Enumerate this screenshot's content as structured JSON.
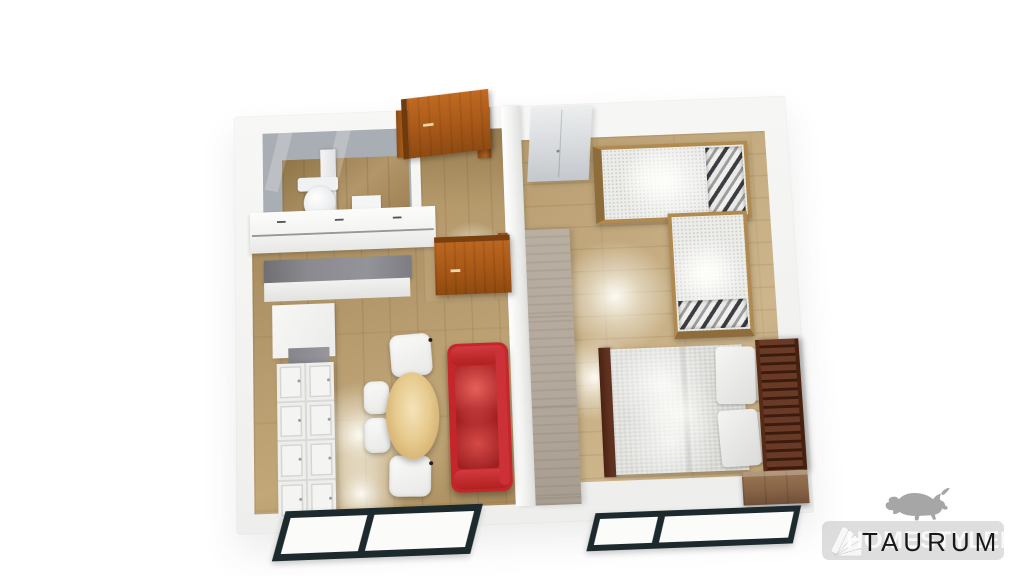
{
  "scene": {
    "description": "3D top-down render of a one-bedroom apartment floor plan",
    "rooms": [
      "bathroom",
      "entry-hall",
      "kitchen-living-dining",
      "bedroom"
    ],
    "furniture": [
      "kitchen-cabinets",
      "kitchen-counter",
      "dining-table",
      "dining-chairs",
      "red-sofa",
      "entry-door",
      "interior-door",
      "toilet",
      "bathroom-sink",
      "white-wardrobe",
      "taupe-wardrobe-divider",
      "l-shaped-daybed",
      "striped-pillows",
      "double-bed",
      "bed-pillows",
      "wood-dresser",
      "living-room-window",
      "bedroom-window"
    ]
  },
  "watermark": {
    "brand_text": "TAURUM",
    "ghost_text": "HOMESTYLER",
    "icons": [
      "bull-icon",
      "fan-icon"
    ],
    "text_color": "#181818",
    "bull_color": "#a6a6a6",
    "bar_color": "rgba(0,0,0,0.13)"
  },
  "palette": {
    "background": "#ffffff",
    "wall_white": "#f3f3f1",
    "wall_gray": "#a9aeb4",
    "floor_living": "#b49a6e",
    "floor_bedroom": "#c3aa7e",
    "floor_bath": "#a98e62",
    "door_wood": "#b05f1e",
    "sofa_red": "#c4262c",
    "table_wood": "#e7cb8e",
    "counter_gray": "#86868c",
    "bed_frame": "#5e2e1e",
    "bedding": "#dcdcd8",
    "daybed_frame": "#b18a50",
    "divider_taupe": "#b1a79a",
    "dresser_wood": "#8d6b49",
    "window_frame": "#1c292d"
  }
}
